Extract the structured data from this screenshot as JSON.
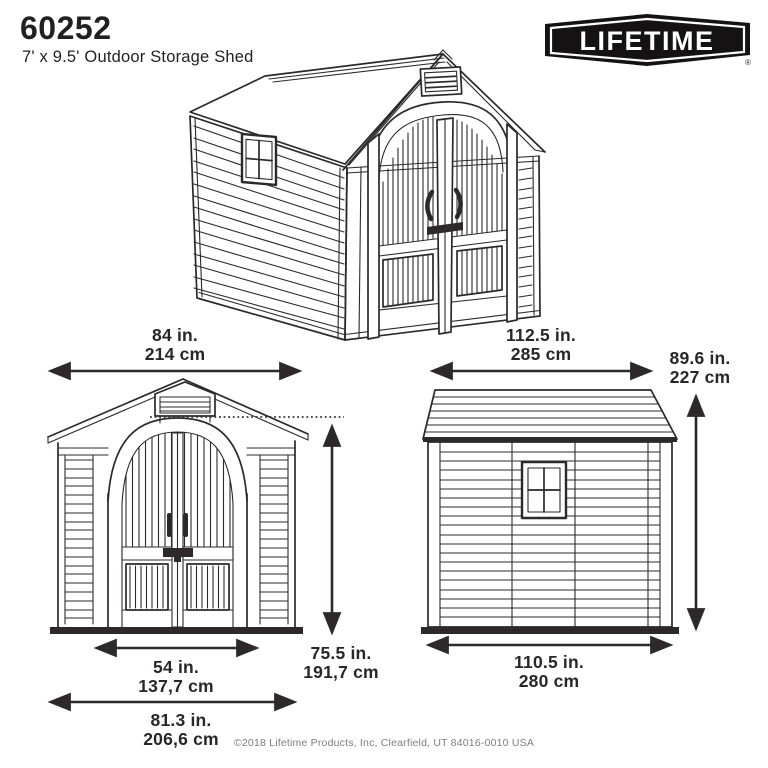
{
  "header": {
    "model": "60252",
    "subtitle": "7' x 9.5' Outdoor Storage Shed"
  },
  "logo": {
    "brand": "LIFETIME",
    "registered_mark": "®"
  },
  "dimensions": {
    "front_width": {
      "inches": "84 in.",
      "metric": "214 cm"
    },
    "side_length": {
      "inches": "112.5 in.",
      "metric": "285 cm"
    },
    "peak_height": {
      "inches": "89.6 in.",
      "metric": "227 cm"
    },
    "door_height": {
      "inches": "75.5 in.",
      "metric": "191,7 cm"
    },
    "door_width": {
      "inches": "54 in.",
      "metric": "137,7 cm"
    },
    "front_base_width": {
      "inches": "81.3 in.",
      "metric": "206,6 cm"
    },
    "side_base_length": {
      "inches": "110.5 in.",
      "metric": "280 cm"
    }
  },
  "footer": {
    "copyright": "©2018 Lifetime Products, Inc, Clearfield, UT 84016-0010 USA"
  },
  "colors": {
    "line": "#2d292a",
    "text": "#231f20",
    "logo_background": "#141213",
    "copyright_text": "#7d7d7d",
    "background": "#ffffff"
  }
}
